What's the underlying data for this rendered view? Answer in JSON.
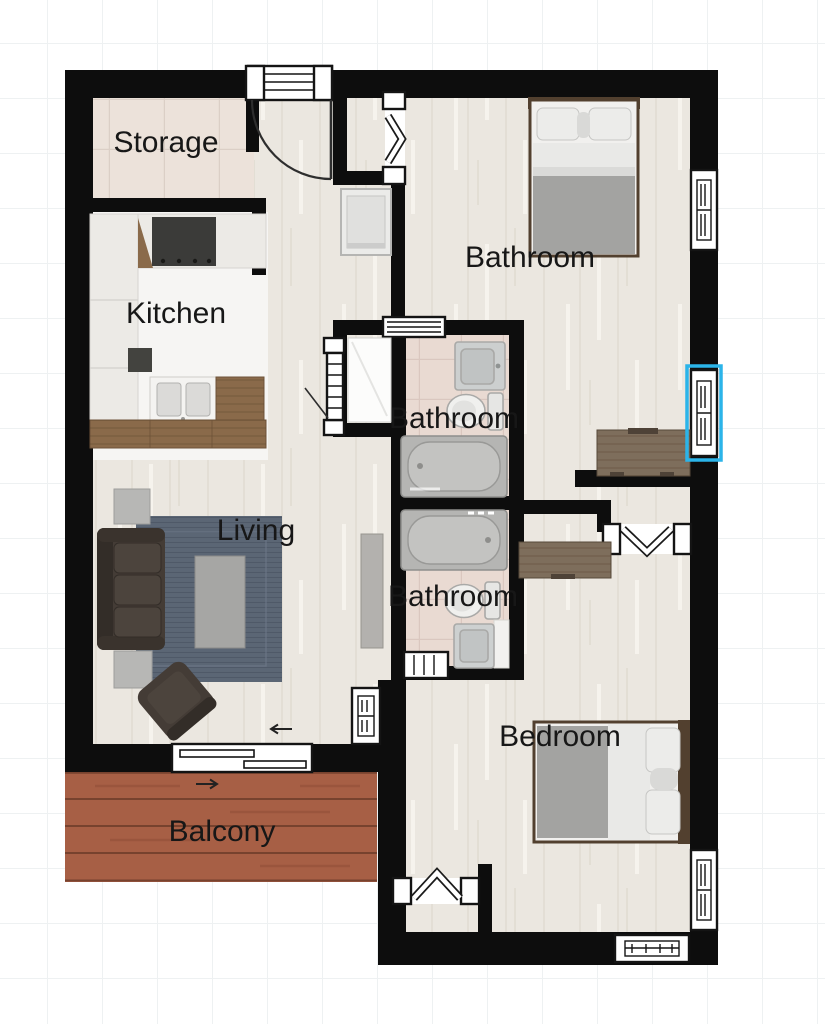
{
  "view": {
    "type": "floor-plan-canvas",
    "background_color": "#ffffff",
    "grid_color": "#eef1f2"
  },
  "floorplan": {
    "rooms": [
      {
        "id": "storage",
        "label": "Storage"
      },
      {
        "id": "kitchen",
        "label": "Kitchen"
      },
      {
        "id": "bathroom-top",
        "label": "Bathroom"
      },
      {
        "id": "bathroom-middle",
        "label": "Bathroom"
      },
      {
        "id": "bathroom-lower",
        "label": "Bathroom"
      },
      {
        "id": "living",
        "label": "Living"
      },
      {
        "id": "bedroom",
        "label": "Bedroom"
      },
      {
        "id": "balcony",
        "label": "Balcony"
      }
    ],
    "selection": {
      "element": "window",
      "wall": "right-exterior-wall",
      "color": "#2bb4e9"
    },
    "colors": {
      "wall": "#0d0d0d",
      "label_text": "#171717",
      "wood_floor": "#ebe7e0",
      "storage_tile": "#ece2da",
      "bathroom_tile": "#e9dad2",
      "kitchen_floor": "#f6f5f3",
      "balcony_deck": "#a75f45",
      "rug": "#5b6675",
      "sofa": "#443c36",
      "coffee_table": "#a6a6a4",
      "bed_blanket": "#a3a3a1",
      "counter_wood": "#8a6a4a",
      "furniture_wood": "#7e6e5c"
    }
  }
}
